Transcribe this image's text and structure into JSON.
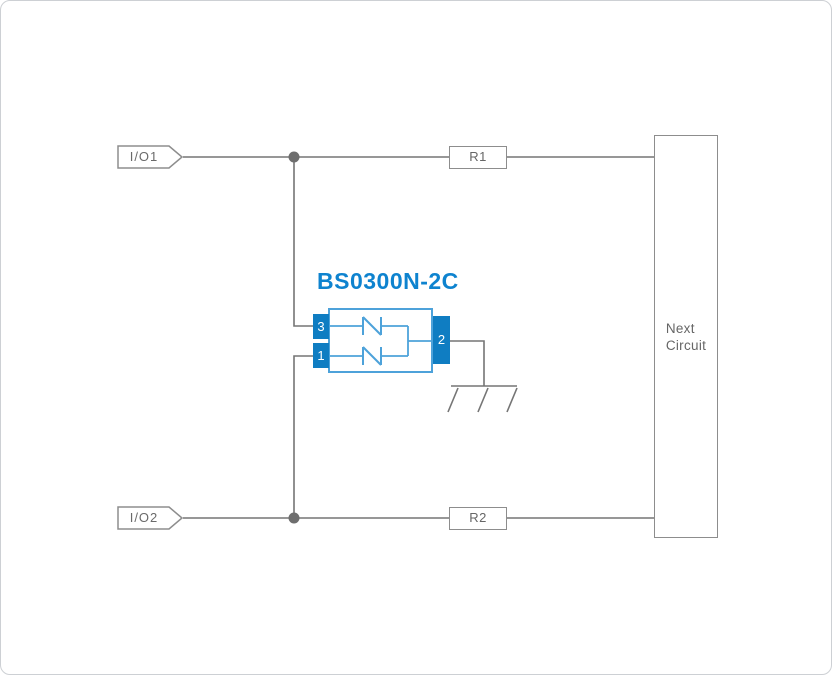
{
  "schematic": {
    "part_title": "BS0300N-2C",
    "io_tags": {
      "io1_label": "I/O1",
      "io2_label": "I/O2"
    },
    "resistors": {
      "r1_label": "R1",
      "r2_label": "R2"
    },
    "next_circuit": {
      "line1": "Next",
      "line2": "Circuit"
    },
    "pins": {
      "pin3_label": "3",
      "pin1_label": "1",
      "pin2_label": "2"
    },
    "colors": {
      "wire_gray": "#757575",
      "box_border_gray": "#8d8d8d",
      "label_gray": "#666666",
      "pin_blue": "#0f7dc2",
      "outline_blue": "#4da2da",
      "title_blue": "#0e83cf"
    }
  }
}
